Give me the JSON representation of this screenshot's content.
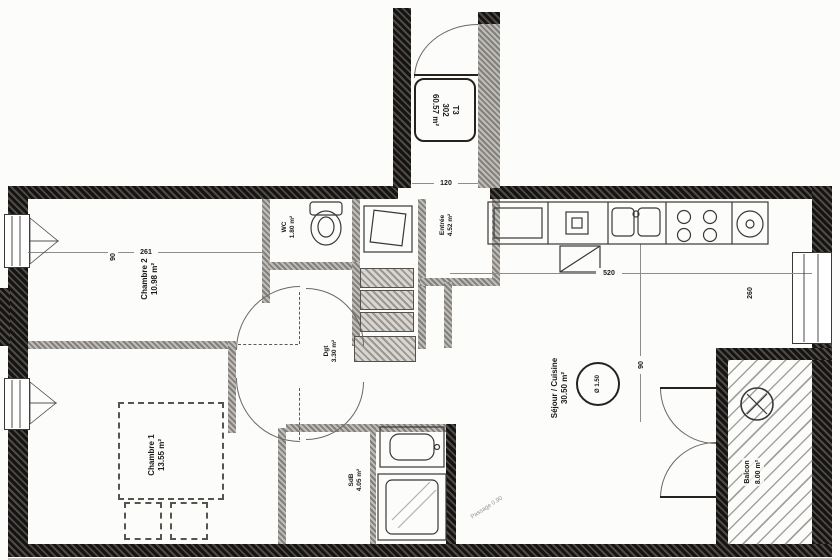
{
  "badge": {
    "type": "T3",
    "lot": "302",
    "area": "60.57 m²"
  },
  "rooms": {
    "chambre2": {
      "name": "Chambre 2",
      "area": "10.98 m²"
    },
    "chambre1": {
      "name": "Chambre 1",
      "area": "13.55 m²"
    },
    "wc": {
      "name": "WC",
      "area": "1.80 m²"
    },
    "entree": {
      "name": "Entrée",
      "area": "4.52 m²"
    },
    "degagement": {
      "name": "Dgt",
      "area": "3.30 m²"
    },
    "sdb": {
      "name": "SdB",
      "area": "4.05 m²"
    },
    "sejour": {
      "name": "Séjour / Cuisine",
      "area": "30.50 m²"
    },
    "balcon": {
      "name": "Balcon",
      "area": "8.00 m²"
    }
  },
  "annotations": {
    "turning_circle": "Ø 1.50",
    "passage": "Passage 0.90"
  },
  "dimensions": {
    "ch2_width": "261",
    "ch2_door": "90",
    "entry_width": "120",
    "sejour_width": "520",
    "sejour_door": "90",
    "window_right": "260"
  },
  "colors": {
    "wall_dark": "#26231f",
    "wall_gray": "#8f8c88",
    "paper": "#fcfcfa",
    "line": "#6b6864"
  }
}
